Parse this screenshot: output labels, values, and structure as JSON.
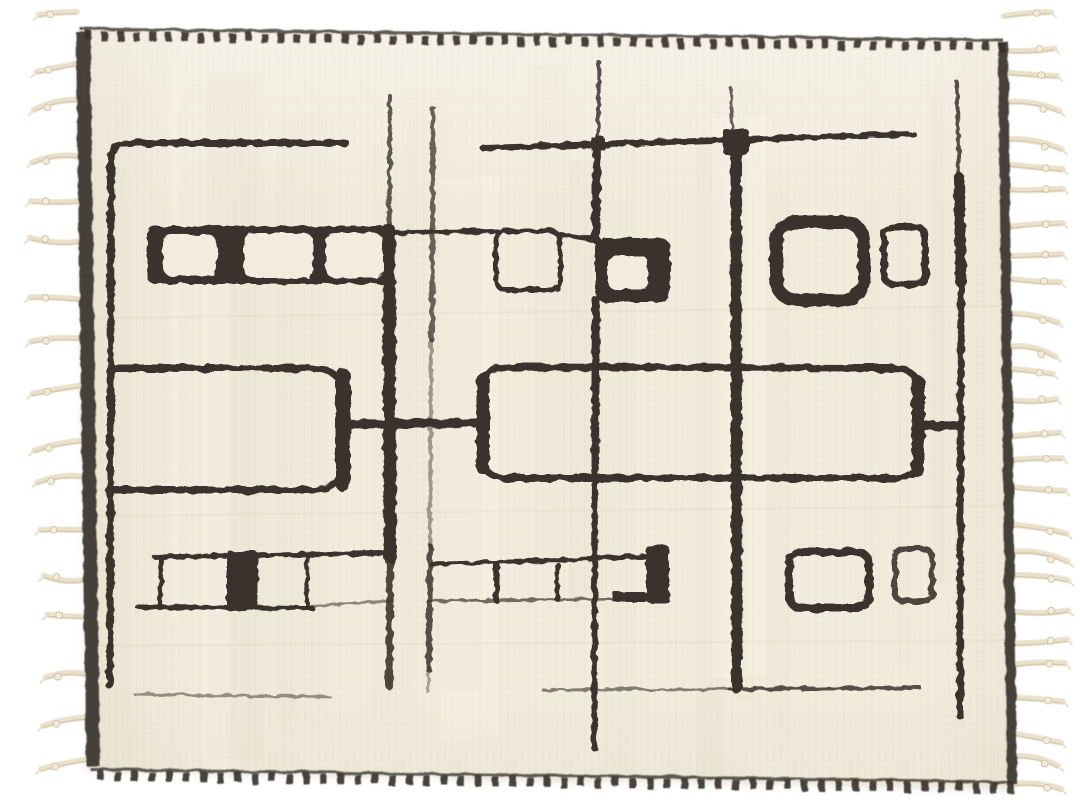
{
  "scene": {
    "type": "product-photograph",
    "description": "Handmade ivory Moroccan wool rug with an abstract dark espresso-brown tribal line pattern, whip-stitched top and bottom edges, and cream braided fringe tassels along the left and right sides, photographed on a plain white background",
    "background": "#ffffff"
  },
  "colors": {
    "ink": "#3a332d",
    "selvage": "#3e3832",
    "cream": "#f1ecdd",
    "cream_shade": "#e0d8c2",
    "cream_bright": "#fbf8ee",
    "fringe": "#eae1cb",
    "fringe_shadow": "#d3c6a9",
    "fringe_knot": "#f2ecda",
    "edge_shadow": "#c8c1ad"
  },
  "rug": {
    "fringe_left_count": 17,
    "fringe_right_count": 27,
    "stitch_top_count": 58,
    "stitch_bottom_count": 54,
    "streak_count": 16,
    "bright_streak_count": 6,
    "motifs": {
      "top_row": [
        "window-band",
        "open-square",
        "solid-square-with-window",
        "thick-open-square",
        "small-open-rectangle"
      ],
      "middle_row": [
        "large-rounded-rectangle-outline",
        "wide-rounded-rectangle-outline",
        "grid-connector-lines"
      ],
      "bottom_row": [
        "window-band-outline",
        "solid-block",
        "rounded-rectangle-outline",
        "small-open-rectangle"
      ],
      "lines": [
        "left-frame-line",
        "center-vertical-lines",
        "right-frame-line",
        "top-horizontal-lines",
        "bottom-horizontal-lines"
      ]
    }
  }
}
